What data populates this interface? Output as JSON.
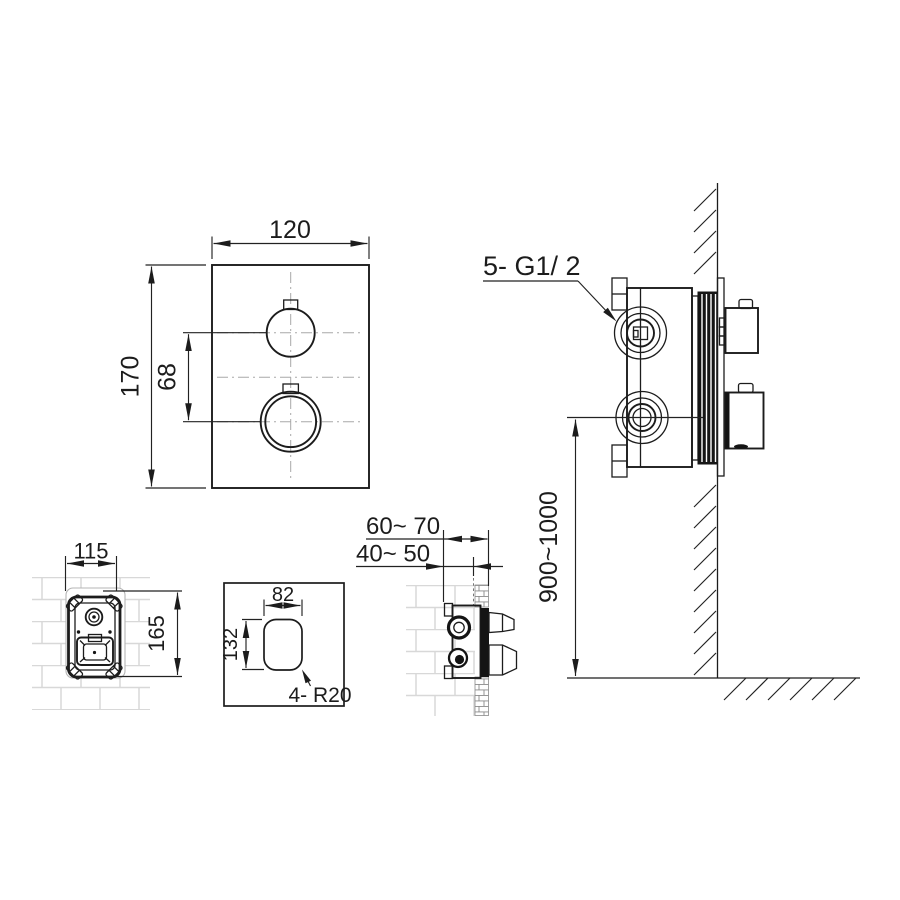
{
  "drawing": {
    "front_view": {
      "plate_width": "120",
      "plate_height": "170",
      "handle_spacing": "68"
    },
    "wall_installation_view": {
      "connection_thread": "5- G1/ 2",
      "mounting_height": "900~1000"
    },
    "rough_in_box_front_view": {
      "box_width": "115",
      "box_height": "165"
    },
    "wall_opening_template": {
      "opening_width": "82",
      "opening_height": "132",
      "corner_radius": "4- R20"
    },
    "rough_in_box_side_view": {
      "depth_to_finished_wall": "60~ 70",
      "depth_to_rough_wall": "40~ 50"
    },
    "colors": {
      "line": "#1c1c1c",
      "brick": "#d8d8d8",
      "centerline": "#a8a8a8",
      "background": "#ffffff"
    }
  }
}
